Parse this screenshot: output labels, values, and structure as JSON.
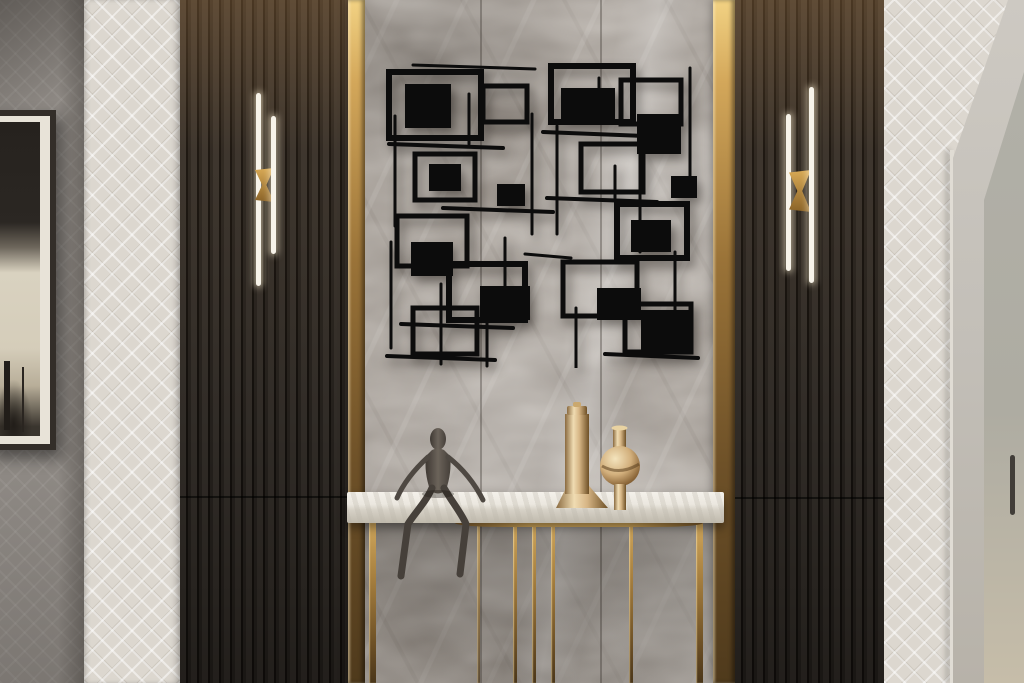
{
  "scene": {
    "objects": {
      "hallway": "Luxury hallway interior scene",
      "left_wall": "Gray side wall",
      "framed_artwork": "Framed abstract artwork",
      "wallpaper_left": "Geometric patterned wallpaper panel",
      "wallpaper_right": "Geometric patterned wallpaper panel",
      "slat_panel_left": "Dark wood slat panel",
      "slat_panel_right": "Dark wood slat panel",
      "gold_trim_left": "Vertical brass trim strip",
      "gold_trim_right": "Vertical brass trim strip",
      "marble_wall": "Gray marble feature wall",
      "wall_art": "Black abstract geometric metal wall art",
      "sconce_left": "Vertical LED wall sconce with brass bracket",
      "sconce_right": "Vertical LED wall sconce with brass bracket",
      "console_table": "White marble top console table with gold legs",
      "figurine": "Dark metal seated figure sculpture",
      "vase_tall": "Tall lidded gold vessel",
      "vase_round": "Round gold vase",
      "door": "Doorway with light stone frame",
      "door_handle": "Slim vertical door handle"
    }
  },
  "palette": {
    "wall-gray": "#8d8883",
    "wallpaper-cream": "#dcd7cf",
    "slat-dark": "#2c2722",
    "gold-bright": "#f2d283",
    "gold-mid": "#9a7338",
    "gold-dark": "#4f3a1c",
    "marble-base": "#9c958e",
    "marble-vein-light": "#cfc9c2",
    "art-black": "#0c0c0c",
    "table-top": "#ebe7df",
    "bronze-figure": "#4e4842",
    "vase-gold": "#d8b987",
    "frame-dark": "#332e29",
    "mat-cream": "#e8e3d8",
    "door-frame": "#c3bfb8",
    "door-panel": "#aeaca2",
    "handle-dark": "#413d38",
    "sconce-light": "#f7f3e9"
  }
}
